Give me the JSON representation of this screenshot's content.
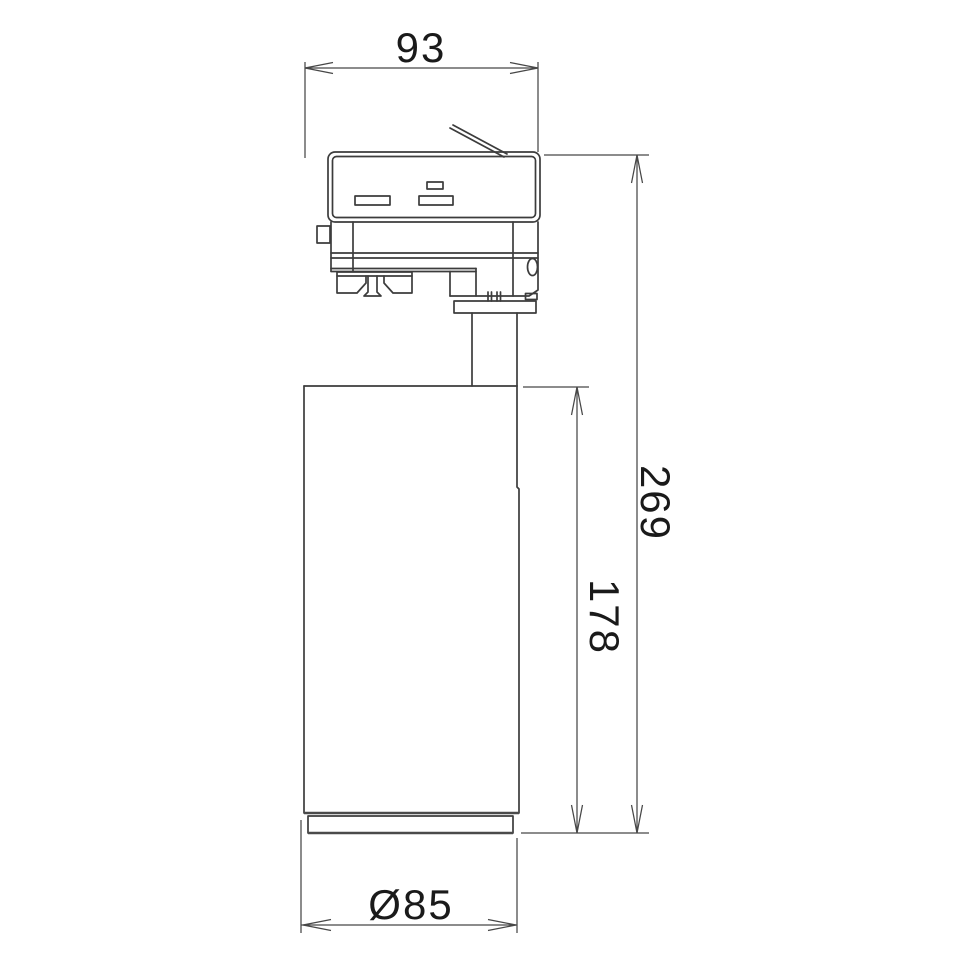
{
  "diagram": {
    "kind": "technical-dimension-drawing",
    "dimensions": {
      "track_adapter_width": {
        "value": "93",
        "orientation": "horizontal",
        "position": "top"
      },
      "overall_height": {
        "value": "269",
        "orientation": "vertical",
        "position": "right-outer"
      },
      "housing_height": {
        "value": "178",
        "orientation": "vertical",
        "position": "right-inner"
      },
      "housing_diameter": {
        "value": "Ø85",
        "orientation": "horizontal",
        "position": "bottom"
      }
    },
    "colors": {
      "background": "#ffffff",
      "object_line": "#3c3c3c",
      "dimension_line": "#474747",
      "text": "#1a1a1a"
    }
  }
}
